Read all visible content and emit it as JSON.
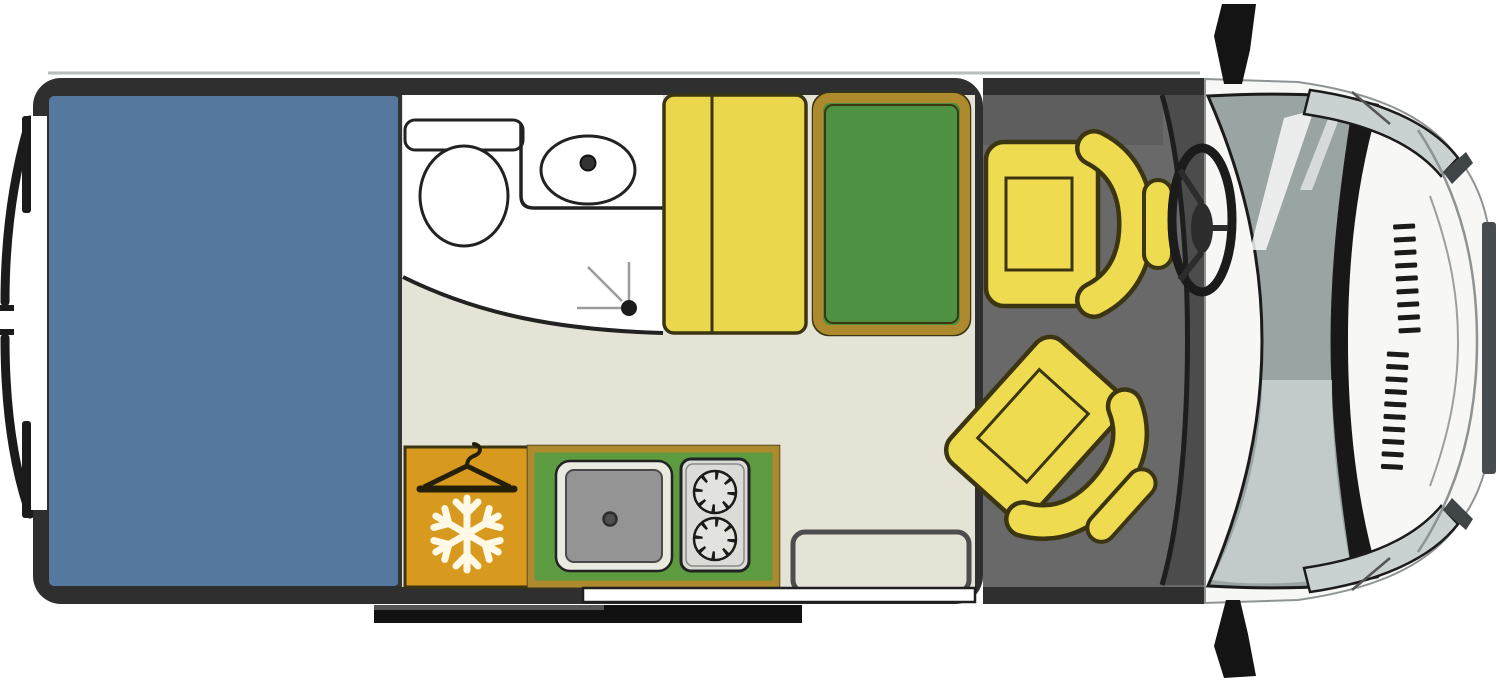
{
  "diagram": {
    "type": "floorplan",
    "subject": "campervan-top-view",
    "regions": [
      {
        "name": "rear-bed"
      },
      {
        "name": "bathroom"
      },
      {
        "name": "wardrobe-fridge-unit"
      },
      {
        "name": "kitchen-block"
      },
      {
        "name": "lounge"
      },
      {
        "name": "cab"
      },
      {
        "name": "van-nose"
      }
    ],
    "icons": [
      {
        "name": "clothes-hanger-icon",
        "meaning": "wardrobe"
      },
      {
        "name": "snowflake-icon",
        "meaning": "refrigerator"
      },
      {
        "name": "toilet-icon",
        "meaning": "toilet"
      },
      {
        "name": "washbasin-icon",
        "meaning": "washbasin"
      },
      {
        "name": "hob-burner-icon",
        "meaning": "two-burner hob"
      },
      {
        "name": "kitchen-sink-icon",
        "meaning": "kitchen sink"
      },
      {
        "name": "steering-wheel-icon",
        "meaning": "driver position"
      }
    ]
  },
  "colors": {
    "wall": "#2F2F2F",
    "bed_blue": "#56779E",
    "floor_beige": "#E5E3D6",
    "white": "#FFFFFF",
    "bench_yellow": "#EBD74B",
    "seat_yellow": "#EFDB50",
    "outline_olive": "#3B3511",
    "green_bed": "#4F9142",
    "green_kitchen": "#5C9B40",
    "gold": "#AD8A2D",
    "orange": "#D8991F",
    "cab_gray": "#696969",
    "dash_gray": "#4C4C4C",
    "glass": "#9AA4A3",
    "glass_light": "#C9D2D1",
    "body_white": "#F7F7F5",
    "ink": "#1B1B1B",
    "stove_gray": "#DBDBD7",
    "sink_gray": "#949494",
    "sink_rim": "#EAEAE0",
    "step_outline": "#4D4D4D",
    "snow": "#FFF9E6"
  }
}
